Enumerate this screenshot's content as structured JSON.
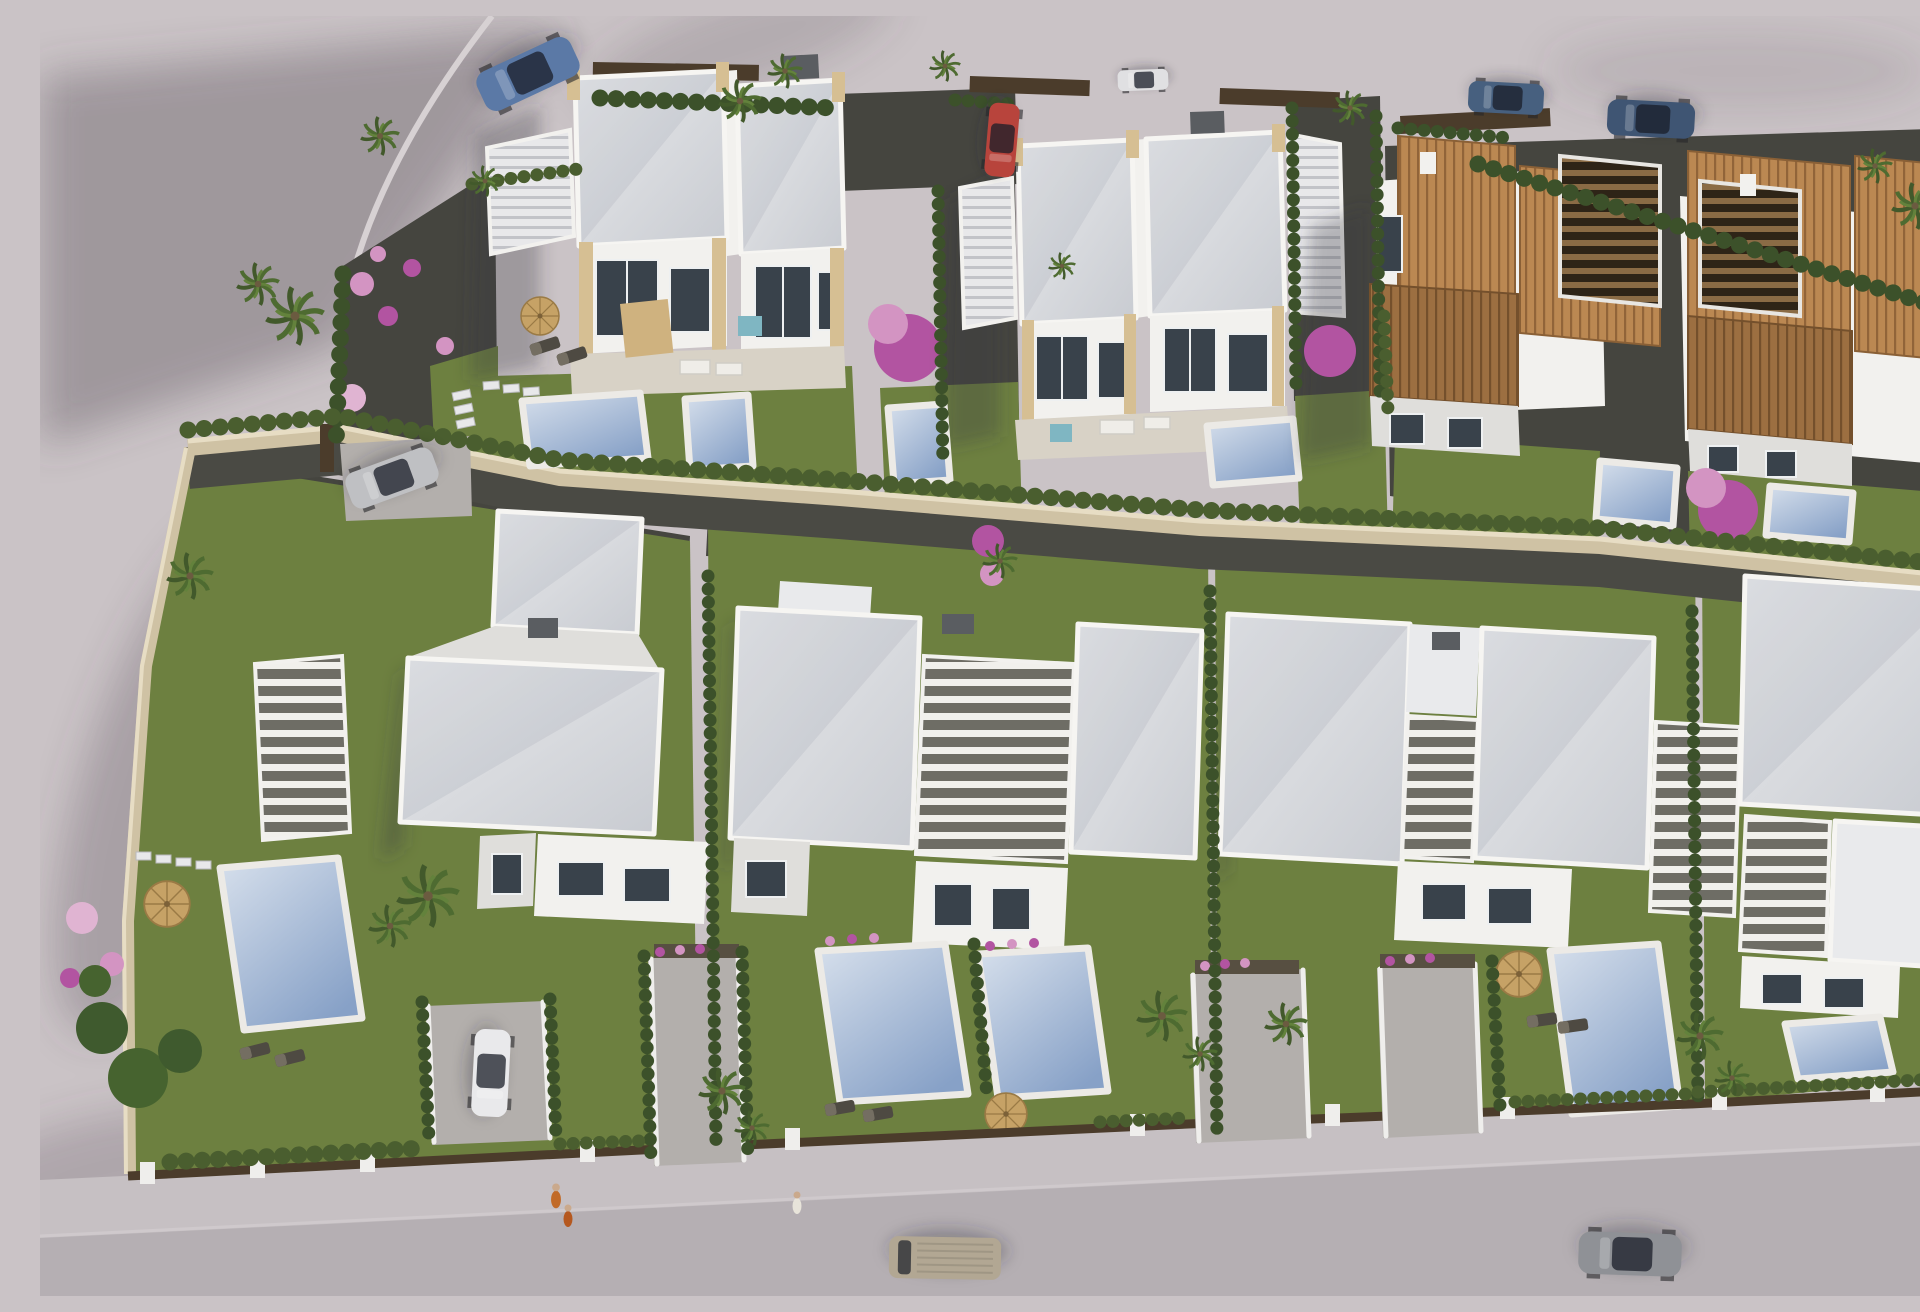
{
  "scene": {
    "title": "Aerial 3D render of a new-build villa development",
    "type": "architectural-visualization",
    "view": "aerial oblique, daytime",
    "description": "Two rows of residences: upper row with two modern white flat-roof duplexes and a cluster of Mediterranean terracotta-roof townhouses; lower row with three large modern white villas with slatted pergolas; private pools, lawns, gravel gardens, cypress hedges, palm trees, parked and moving cars, and a street along the bottom."
  },
  "colors": {
    "pavement": "#cac3c6",
    "road": "#b5afb3",
    "sidewalk": "#c6c0c3",
    "curb": "#d7d1d3",
    "white_wall": "#f2f1ee",
    "white_shade": "#dfdedb",
    "roof_light": "#e8e9eb",
    "roof_shade": "#c6c9cf",
    "sandstone": "#d6bf93",
    "window_dark": "#39424b",
    "lawn": "#6d8040",
    "lawn_light": "#7d9049",
    "hedge_dark": "#3c512a",
    "hedge_light": "#4a5e2f",
    "gravel": "#45453f",
    "driveway": "#b3afac",
    "stone_wall": "#cfc2a4",
    "stone_wall_top": "#e7ddc4",
    "pool_light": "#d7e0ec",
    "pool_deep": "#87a1c7",
    "pool_deck": "#eceae6",
    "terracotta": "#bb8852",
    "terracotta_dark": "#9c6f41",
    "pergola_wood": "#8a6b45",
    "flower_magenta": "#b254a1",
    "flower_pink": "#d394c2",
    "palm_green": "#4e6b31",
    "terrace": "#d8d2c6",
    "fence_brown": "#4b3c2b"
  },
  "objects": {
    "buildings": [
      {
        "name": "upper-left-modern-duplex",
        "style": "white flat-roof duplex with sandstone pillars, roof-terrace stairs, two front pools"
      },
      {
        "name": "upper-center-modern-duplex",
        "style": "white flat-roof duplex with sandstone pillars, terrace and front pools"
      },
      {
        "name": "mediterranean-villas",
        "style": "white villas with terracotta tile roofs and dark timber pergola stairs, front pools"
      },
      {
        "name": "lower-left-villa",
        "style": "modern white villa with slatted pergola, private pool and lawn garden"
      },
      {
        "name": "lower-center-duplex",
        "style": "modern white duplex with central pergola and two front pools"
      },
      {
        "name": "lower-right-duplex",
        "style": "modern white duplex with side pergola, driveways and pool"
      },
      {
        "name": "lower-far-right-villa",
        "style": "partially visible white villa with pergola and pool"
      }
    ],
    "vehicles": [
      {
        "name": "blue-coupe",
        "color": "#5b79a6",
        "location": "top-left street"
      },
      {
        "name": "white-hatchback",
        "color": "#e0e0e2",
        "location": "top street"
      },
      {
        "name": "red-hatchback",
        "color": "#b8443c",
        "location": "driveway pocket between upper duplexes"
      },
      {
        "name": "dark-blue-suv-a",
        "color": "#47607f",
        "location": "top-right street"
      },
      {
        "name": "dark-blue-suv-b",
        "color": "#3f5573",
        "location": "top-right street"
      },
      {
        "name": "silver-suv",
        "color": "#bfc0c3",
        "location": "upper-left driveway"
      },
      {
        "name": "white-compact",
        "color": "#e9e9eb",
        "location": "lower-left driveway"
      },
      {
        "name": "beige-van",
        "color": "#b2a793",
        "location": "bottom road, driving"
      },
      {
        "name": "gray-coupe",
        "color": "#8f9196",
        "location": "bottom road, driving"
      }
    ],
    "pools": {
      "count": 12,
      "colors": [
        "#d7e0ec",
        "#87a1c7"
      ]
    },
    "people": [
      {
        "name": "walkers-orange",
        "location": "bottom sidewalk left, two figures"
      },
      {
        "name": "pedestrian-white",
        "location": "bottom sidewalk center"
      }
    ],
    "landscape": [
      "palm trees",
      "cypress hedges",
      "bougainvillea trees",
      "pink flower balls",
      "lawns",
      "dark gravel gardens",
      "stepping stones",
      "wicker parasols",
      "sun loungers",
      "stone boundary wall",
      "brown front fence with white piers"
    ]
  }
}
